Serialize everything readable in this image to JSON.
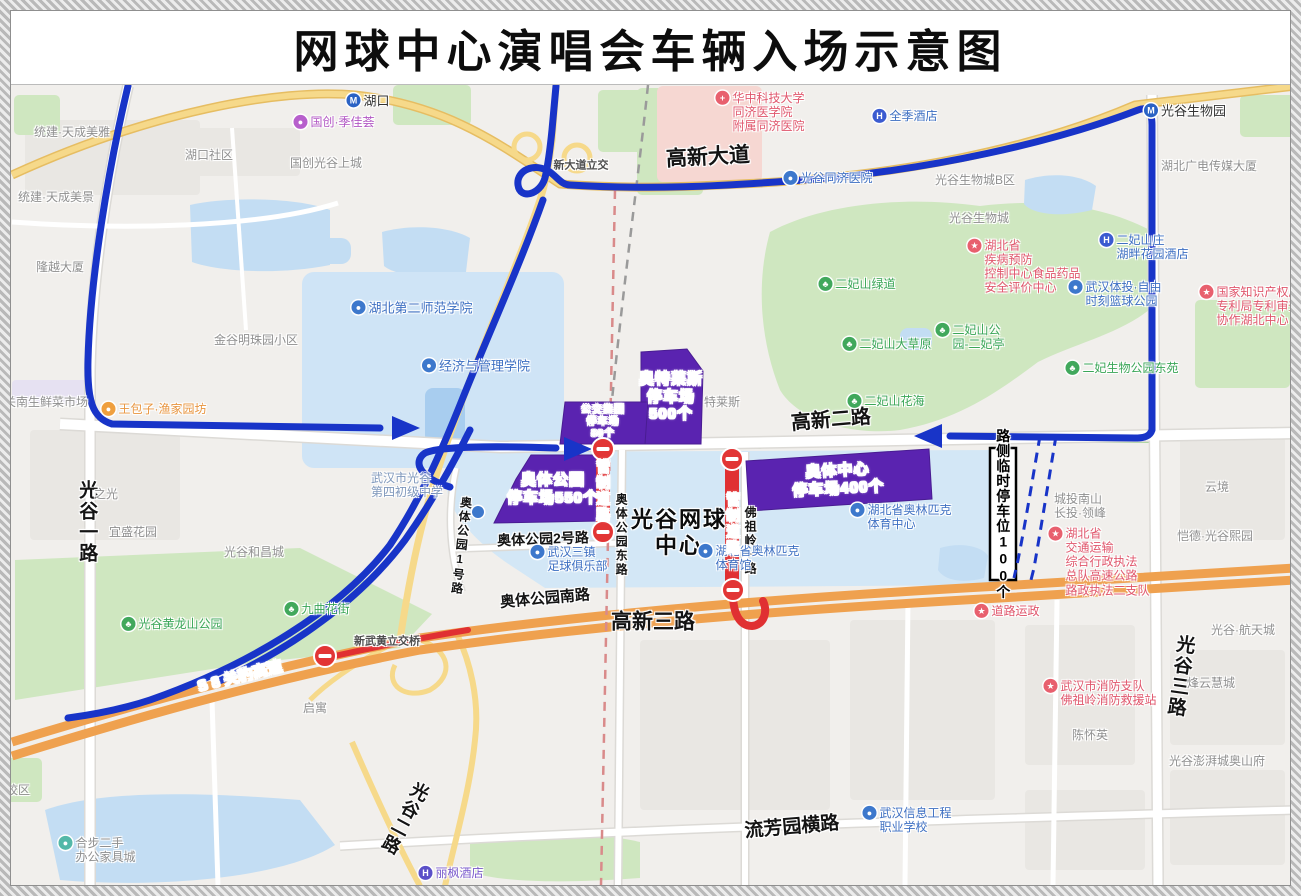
{
  "title": "网球中心演唱会车辆入场示意图",
  "colors": {
    "route_blue": "#1834c8",
    "route_red": "#e03032",
    "no_entry_red": "#e23535",
    "parking_purple": "#5a23b0",
    "highway_orange": "#efa14f",
    "road_yellow": "#f6d98a",
    "green_area": "#cfe7c0",
    "water_area": "#c3ddf3",
    "hospital_pink": "#f6d7d2",
    "poi_blue": "#3d6fc2",
    "poi_green": "#3aa657",
    "poi_red": "#e0566c",
    "poi_gray": "#8f8f8f"
  },
  "map": {
    "labels": [
      {
        "k": "road",
        "t": "高新大道",
        "x": 708,
        "y": 158,
        "s": 21,
        "r": -3
      },
      {
        "k": "road",
        "t": "高新二路",
        "x": 831,
        "y": 421,
        "s": 20,
        "r": -5
      },
      {
        "k": "road",
        "t": "高新三路",
        "x": 653,
        "y": 623,
        "s": 21
      },
      {
        "k": "road",
        "t": "奥体公园南路",
        "x": 545,
        "y": 599,
        "s": 15,
        "r": -5
      },
      {
        "k": "road",
        "t": "奥体公园2号路",
        "x": 543,
        "y": 539,
        "s": 14,
        "r": -2
      },
      {
        "k": "road",
        "t": "奥体公园东路",
        "x": 621,
        "y": 535,
        "s": 12,
        "v": 1
      },
      {
        "k": "road",
        "t": "奥体公园1号路",
        "x": 461,
        "y": 546,
        "s": 12,
        "v": 1,
        "r": 6
      },
      {
        "k": "road",
        "t": "佛祖岭一路",
        "x": 750,
        "y": 541,
        "s": 12,
        "v": 1
      },
      {
        "k": "road",
        "t": "光谷一路",
        "x": 86,
        "y": 522,
        "s": 19,
        "v": 1
      },
      {
        "k": "road",
        "t": "光谷二路",
        "x": 404,
        "y": 818,
        "s": 18,
        "v": 1,
        "r": 28
      },
      {
        "k": "road",
        "t": "光谷三路",
        "x": 1179,
        "y": 676,
        "s": 19,
        "v": 1,
        "r": 8
      },
      {
        "k": "road",
        "t": "流芳园横路",
        "x": 792,
        "y": 828,
        "s": 19,
        "r": -5
      },
      {
        "k": "venue",
        "l": [
          "光谷网球",
          "中心"
        ],
        "x": 679,
        "y": 533,
        "s": 22
      },
      {
        "k": "roadw",
        "t": "S 8 关豹高速",
        "x": 240,
        "y": 677,
        "s": 15,
        "r": -14
      },
      {
        "k": "gray2",
        "t": "新武黄立交桥",
        "x": 387,
        "y": 642,
        "s": 11
      },
      {
        "k": "gray2",
        "t": "新大道立交",
        "x": 581,
        "y": 166,
        "s": 11
      },
      {
        "k": "poi",
        "t": "湖口",
        "x": 368,
        "y": 101,
        "s": 13,
        "c": "#333333",
        "i": "M",
        "ic": "#2a62c4"
      },
      {
        "k": "poi",
        "t": "光谷生物园",
        "x": 1185,
        "y": 111,
        "s": 13,
        "c": "#333333",
        "i": "M",
        "ic": "#2a62c4"
      },
      {
        "k": "poi",
        "t": "光谷同济医院",
        "x": 828,
        "y": 178,
        "s": 12,
        "c": "#3d6fc2",
        "i": "●",
        "ic": "#3d78cc"
      },
      {
        "k": "poi",
        "t": "全季酒店",
        "x": 905,
        "y": 116,
        "s": 12,
        "c": "#3d6fc2",
        "i": "H",
        "ic": "#3b5bd0"
      },
      {
        "k": "poi",
        "l": [
          "二妃山庄",
          "湖畔花园酒店"
        ],
        "x": 1144,
        "y": 247,
        "s": 12,
        "c": "#3d6fc2",
        "i": "H",
        "ic": "#3b5bd0"
      },
      {
        "k": "poi",
        "l": [
          "武汉体投·自由",
          "时刻篮球公园"
        ],
        "x": 1115,
        "y": 294,
        "s": 12,
        "c": "#3d6fc2",
        "i": "●",
        "ic": "#3d78cc"
      },
      {
        "k": "poi",
        "l": [
          "武汉三镇",
          "足球俱乐部"
        ],
        "x": 569,
        "y": 559,
        "s": 12,
        "c": "#3d6fc2",
        "i": "●",
        "ic": "#3d78cc"
      },
      {
        "k": "poi",
        "l": [
          "湖北省奥林匹克",
          "体育中心"
        ],
        "x": 901,
        "y": 517,
        "s": 12,
        "c": "#3d6fc2",
        "i": "●",
        "ic": "#3d78cc"
      },
      {
        "k": "poi",
        "l": [
          "湖北省奥林匹克",
          "体育馆"
        ],
        "x": 749,
        "y": 558,
        "s": 12,
        "c": "#3d6fc2",
        "i": "●",
        "ic": "#3d78cc"
      },
      {
        "k": "poi",
        "l": [
          "武汉信息工程",
          "职业学校"
        ],
        "x": 907,
        "y": 820,
        "s": 12,
        "c": "#3d6fc2",
        "i": "●",
        "ic": "#3d78cc"
      },
      {
        "k": "poi",
        "t": "丽枫酒店",
        "x": 451,
        "y": 873,
        "s": 12,
        "c": "#7a5acc",
        "i": "H",
        "ic": "#5b50c8"
      },
      {
        "k": "poi",
        "t": "湖北第二师范学院",
        "x": 412,
        "y": 308,
        "s": 13,
        "c": "#3d6fc2",
        "i": "●",
        "ic": "#3d78cc"
      },
      {
        "k": "poi",
        "t": "经济与管理学院",
        "x": 476,
        "y": 366,
        "s": 13,
        "c": "#3d6fc2",
        "i": "●",
        "ic": "#3d78cc"
      },
      {
        "k": "gray",
        "l": [
          "武汉市光谷",
          "第四初级中学"
        ],
        "x": 407,
        "y": 485,
        "s": 12,
        "c": "#7e97bb"
      },
      {
        "k": "gray",
        "t": "湖北广电传媒大厦",
        "x": 1209,
        "y": 166,
        "s": 12
      },
      {
        "k": "poi",
        "t": "国创·季佳荟",
        "x": 334,
        "y": 122,
        "s": 12,
        "c": "#b257c4",
        "i": "●",
        "ic": "#b75fcc"
      },
      {
        "k": "poi",
        "t": "王包子·渔家园坊",
        "x": 154,
        "y": 409,
        "s": 12,
        "c": "#e8953f",
        "i": "●",
        "ic": "#ef9f3e"
      },
      {
        "k": "poi",
        "t": "九曲花街",
        "x": 317,
        "y": 609,
        "s": 12,
        "c": "#3aa657",
        "i": "♣",
        "ic": "#41a85c"
      },
      {
        "k": "poi",
        "t": "光谷黄龙山公园",
        "x": 172,
        "y": 624,
        "s": 12,
        "c": "#3aa657",
        "i": "♣",
        "ic": "#41a85c"
      },
      {
        "k": "poi",
        "t": "二妃山绿道",
        "x": 857,
        "y": 284,
        "s": 12,
        "c": "#3aa657",
        "i": "♣",
        "ic": "#41a85c"
      },
      {
        "k": "poi",
        "t": "二妃山大草原",
        "x": 887,
        "y": 344,
        "s": 12,
        "c": "#3aa657",
        "i": "♣",
        "ic": "#41a85c"
      },
      {
        "k": "poi",
        "l": [
          "二妃山公",
          "园-二妃亭"
        ],
        "x": 970,
        "y": 337,
        "s": 12,
        "c": "#3aa657",
        "i": "♣",
        "ic": "#41a85c"
      },
      {
        "k": "poi",
        "t": "二妃山花海",
        "x": 886,
        "y": 401,
        "s": 12,
        "c": "#3aa657",
        "i": "♣",
        "ic": "#41a85c"
      },
      {
        "k": "poi",
        "t": "二妃生物公园东苑",
        "x": 1122,
        "y": 368,
        "s": 12,
        "c": "#3aa657",
        "i": "♣",
        "ic": "#41a85c"
      },
      {
        "k": "poi",
        "l": [
          "华中科技大学",
          "同济医学院",
          "附属同济医院"
        ],
        "x": 760,
        "y": 112,
        "s": 12,
        "c": "#e0566c",
        "i": "+",
        "ic": "#e8606e"
      },
      {
        "k": "poi",
        "l": [
          "湖北省",
          "疾病预防",
          "控制中心食品药品",
          "安全评价中心"
        ],
        "x": 1024,
        "y": 267,
        "s": 12,
        "c": "#e0566c",
        "i": "★",
        "ic": "#e8606e"
      },
      {
        "k": "poi",
        "l": [
          "国家知识产权局",
          "专利局专利审查",
          "协作湖北中心"
        ],
        "x": 1250,
        "y": 306,
        "s": 12,
        "c": "#e0566c",
        "i": "★",
        "ic": "#e8606e"
      },
      {
        "k": "poi",
        "l": [
          "湖北省",
          "交通运输",
          "综合行政执法",
          "总队高速公路",
          "路政执法二支队"
        ],
        "x": 1099,
        "y": 562,
        "s": 12,
        "c": "#e0566c",
        "i": "★",
        "ic": "#e8606e"
      },
      {
        "k": "poi",
        "t": "道路运政",
        "x": 1007,
        "y": 611,
        "s": 12,
        "c": "#e0566c",
        "i": "★",
        "ic": "#e8606e"
      },
      {
        "k": "poi",
        "l": [
          "武汉市消防支队",
          "佛祖岭消防救援站"
        ],
        "x": 1100,
        "y": 693,
        "s": 12,
        "c": "#e0566c",
        "i": "★",
        "ic": "#e8606e"
      },
      {
        "k": "gray",
        "t": "统建·天成美雅",
        "x": 72,
        "y": 132,
        "s": 12
      },
      {
        "k": "gray",
        "t": "湖口社区",
        "x": 209,
        "y": 155,
        "s": 12
      },
      {
        "k": "gray",
        "t": "国创光谷上城",
        "x": 326,
        "y": 163,
        "s": 12
      },
      {
        "k": "gray",
        "t": "统建·天成美景",
        "x": 56,
        "y": 197,
        "s": 12
      },
      {
        "k": "gray",
        "t": "隆越大厦",
        "x": 60,
        "y": 267,
        "s": 12
      },
      {
        "k": "gray",
        "t": "金谷明珠园小区",
        "x": 256,
        "y": 340,
        "s": 12
      },
      {
        "k": "gray",
        "t": "关南生鲜菜市场",
        "x": 46,
        "y": 402,
        "s": 12
      },
      {
        "k": "gray",
        "t": "宜盛花园",
        "x": 133,
        "y": 532,
        "s": 12
      },
      {
        "k": "gray",
        "t": "之光",
        "x": 106,
        "y": 494,
        "s": 12
      },
      {
        "k": "gray",
        "t": "光谷和昌城",
        "x": 254,
        "y": 552,
        "s": 12
      },
      {
        "k": "gray",
        "t": "启寓",
        "x": 315,
        "y": 708,
        "s": 12
      },
      {
        "k": "gray",
        "l": [
          "城投南山",
          "长投·领峰"
        ],
        "x": 1080,
        "y": 506,
        "s": 12
      },
      {
        "k": "gray",
        "t": "云境",
        "x": 1217,
        "y": 487,
        "s": 12
      },
      {
        "k": "gray",
        "t": "恺德·光谷熙园",
        "x": 1215,
        "y": 536,
        "s": 12
      },
      {
        "k": "gray",
        "t": "光谷·航天城",
        "x": 1243,
        "y": 630,
        "s": 12
      },
      {
        "k": "gray",
        "t": "烽云慧城",
        "x": 1211,
        "y": 683,
        "s": 12
      },
      {
        "k": "gray",
        "t": "光谷澎湃城奥山府",
        "x": 1217,
        "y": 761,
        "s": 12
      },
      {
        "k": "gray",
        "t": "陈怀英",
        "x": 1090,
        "y": 735,
        "s": 12
      },
      {
        "k": "gray",
        "t": "光谷生物城B区",
        "x": 975,
        "y": 180,
        "s": 12
      },
      {
        "k": "gray",
        "t": "光谷生物城",
        "x": 979,
        "y": 218,
        "s": 12
      },
      {
        "k": "gray",
        "t": "特莱斯",
        "x": 722,
        "y": 402,
        "s": 12
      },
      {
        "k": "poi",
        "l": [
          "合步二手",
          "办公家具城"
        ],
        "x": 97,
        "y": 850,
        "s": 12,
        "c": "#8f8f8f",
        "i": "●",
        "ic": "#53b8a8"
      },
      {
        "k": "gray",
        "t": "校区",
        "x": 18,
        "y": 790,
        "s": 12
      },
      {
        "k": "parking",
        "l": [
          "奥特莱斯",
          "停车场",
          "500个"
        ],
        "x": 671,
        "y": 397,
        "s": 15
      },
      {
        "k": "parking",
        "l": [
          "公交集团",
          "停车场",
          "80个"
        ],
        "x": 603,
        "y": 422,
        "s": 10
      },
      {
        "k": "parking",
        "l": [
          "奥体公园",
          "停车场550个"
        ],
        "x": 553,
        "y": 489,
        "s": 15
      },
      {
        "k": "parking",
        "l": [
          "奥体中心",
          "停车场400个"
        ],
        "x": 838,
        "y": 480,
        "s": 15,
        "r": -3
      },
      {
        "k": "sidep",
        "t": "路侧临时停车位100个",
        "x": 1003,
        "y": 514,
        "s": 14
      },
      {
        "k": "control",
        "t": "管制道路",
        "x": 603,
        "y": 491,
        "s": 14
      },
      {
        "k": "control",
        "t": "管制道路",
        "x": 733,
        "y": 524,
        "s": 14
      },
      {
        "k": "dot",
        "x": 478,
        "y": 512,
        "ic": "#3d78cc"
      }
    ]
  }
}
